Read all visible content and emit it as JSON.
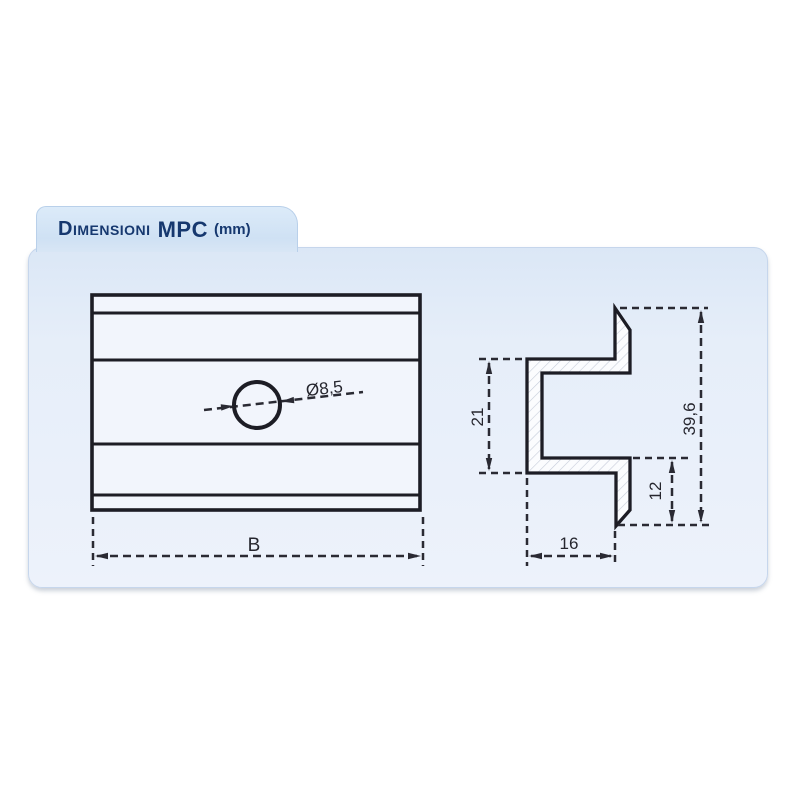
{
  "header": {
    "title_name": "Dimensioni",
    "title_product": "MPC",
    "title_unit": "(mm)",
    "unit": "mm"
  },
  "drawing": {
    "front_view": {
      "name": "plan view of MPC mounting plate",
      "hole_diameter_label": "Ø8,5",
      "width_label": "B"
    },
    "side_view": {
      "name": "cross-section profile of MPC",
      "web_height_label": "21",
      "total_height_label": "39,6",
      "lip_height_label": "12",
      "depth_label": "16"
    }
  },
  "colors": {
    "panel_background": "#e6eef9",
    "tab_background": "#cfe1f4",
    "title_text": "#16386f",
    "line_color": "#1d1d25",
    "dimension_color": "#2a2a33",
    "hatch_color": "#c6cdda"
  }
}
